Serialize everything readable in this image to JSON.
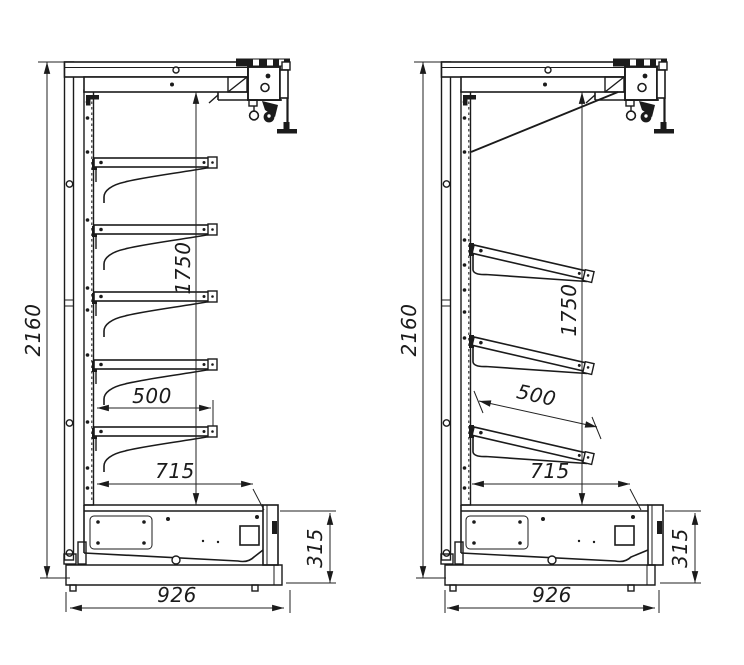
{
  "drawing": {
    "background": "#ffffff",
    "line_color": "#1b1b1b",
    "dim_text_color": "#1b1b1b",
    "views": [
      {
        "dimensions": {
          "overall_height": "2160",
          "mount_height": "1750",
          "shelf_depth": "500",
          "base_depth": "715",
          "base_height": "315",
          "overall_depth": "926"
        }
      },
      {
        "dimensions": {
          "overall_height": "2160",
          "mount_height": "1750",
          "shelf_depth": "500",
          "base_depth": "715",
          "base_height": "315",
          "overall_depth": "926"
        }
      }
    ]
  }
}
